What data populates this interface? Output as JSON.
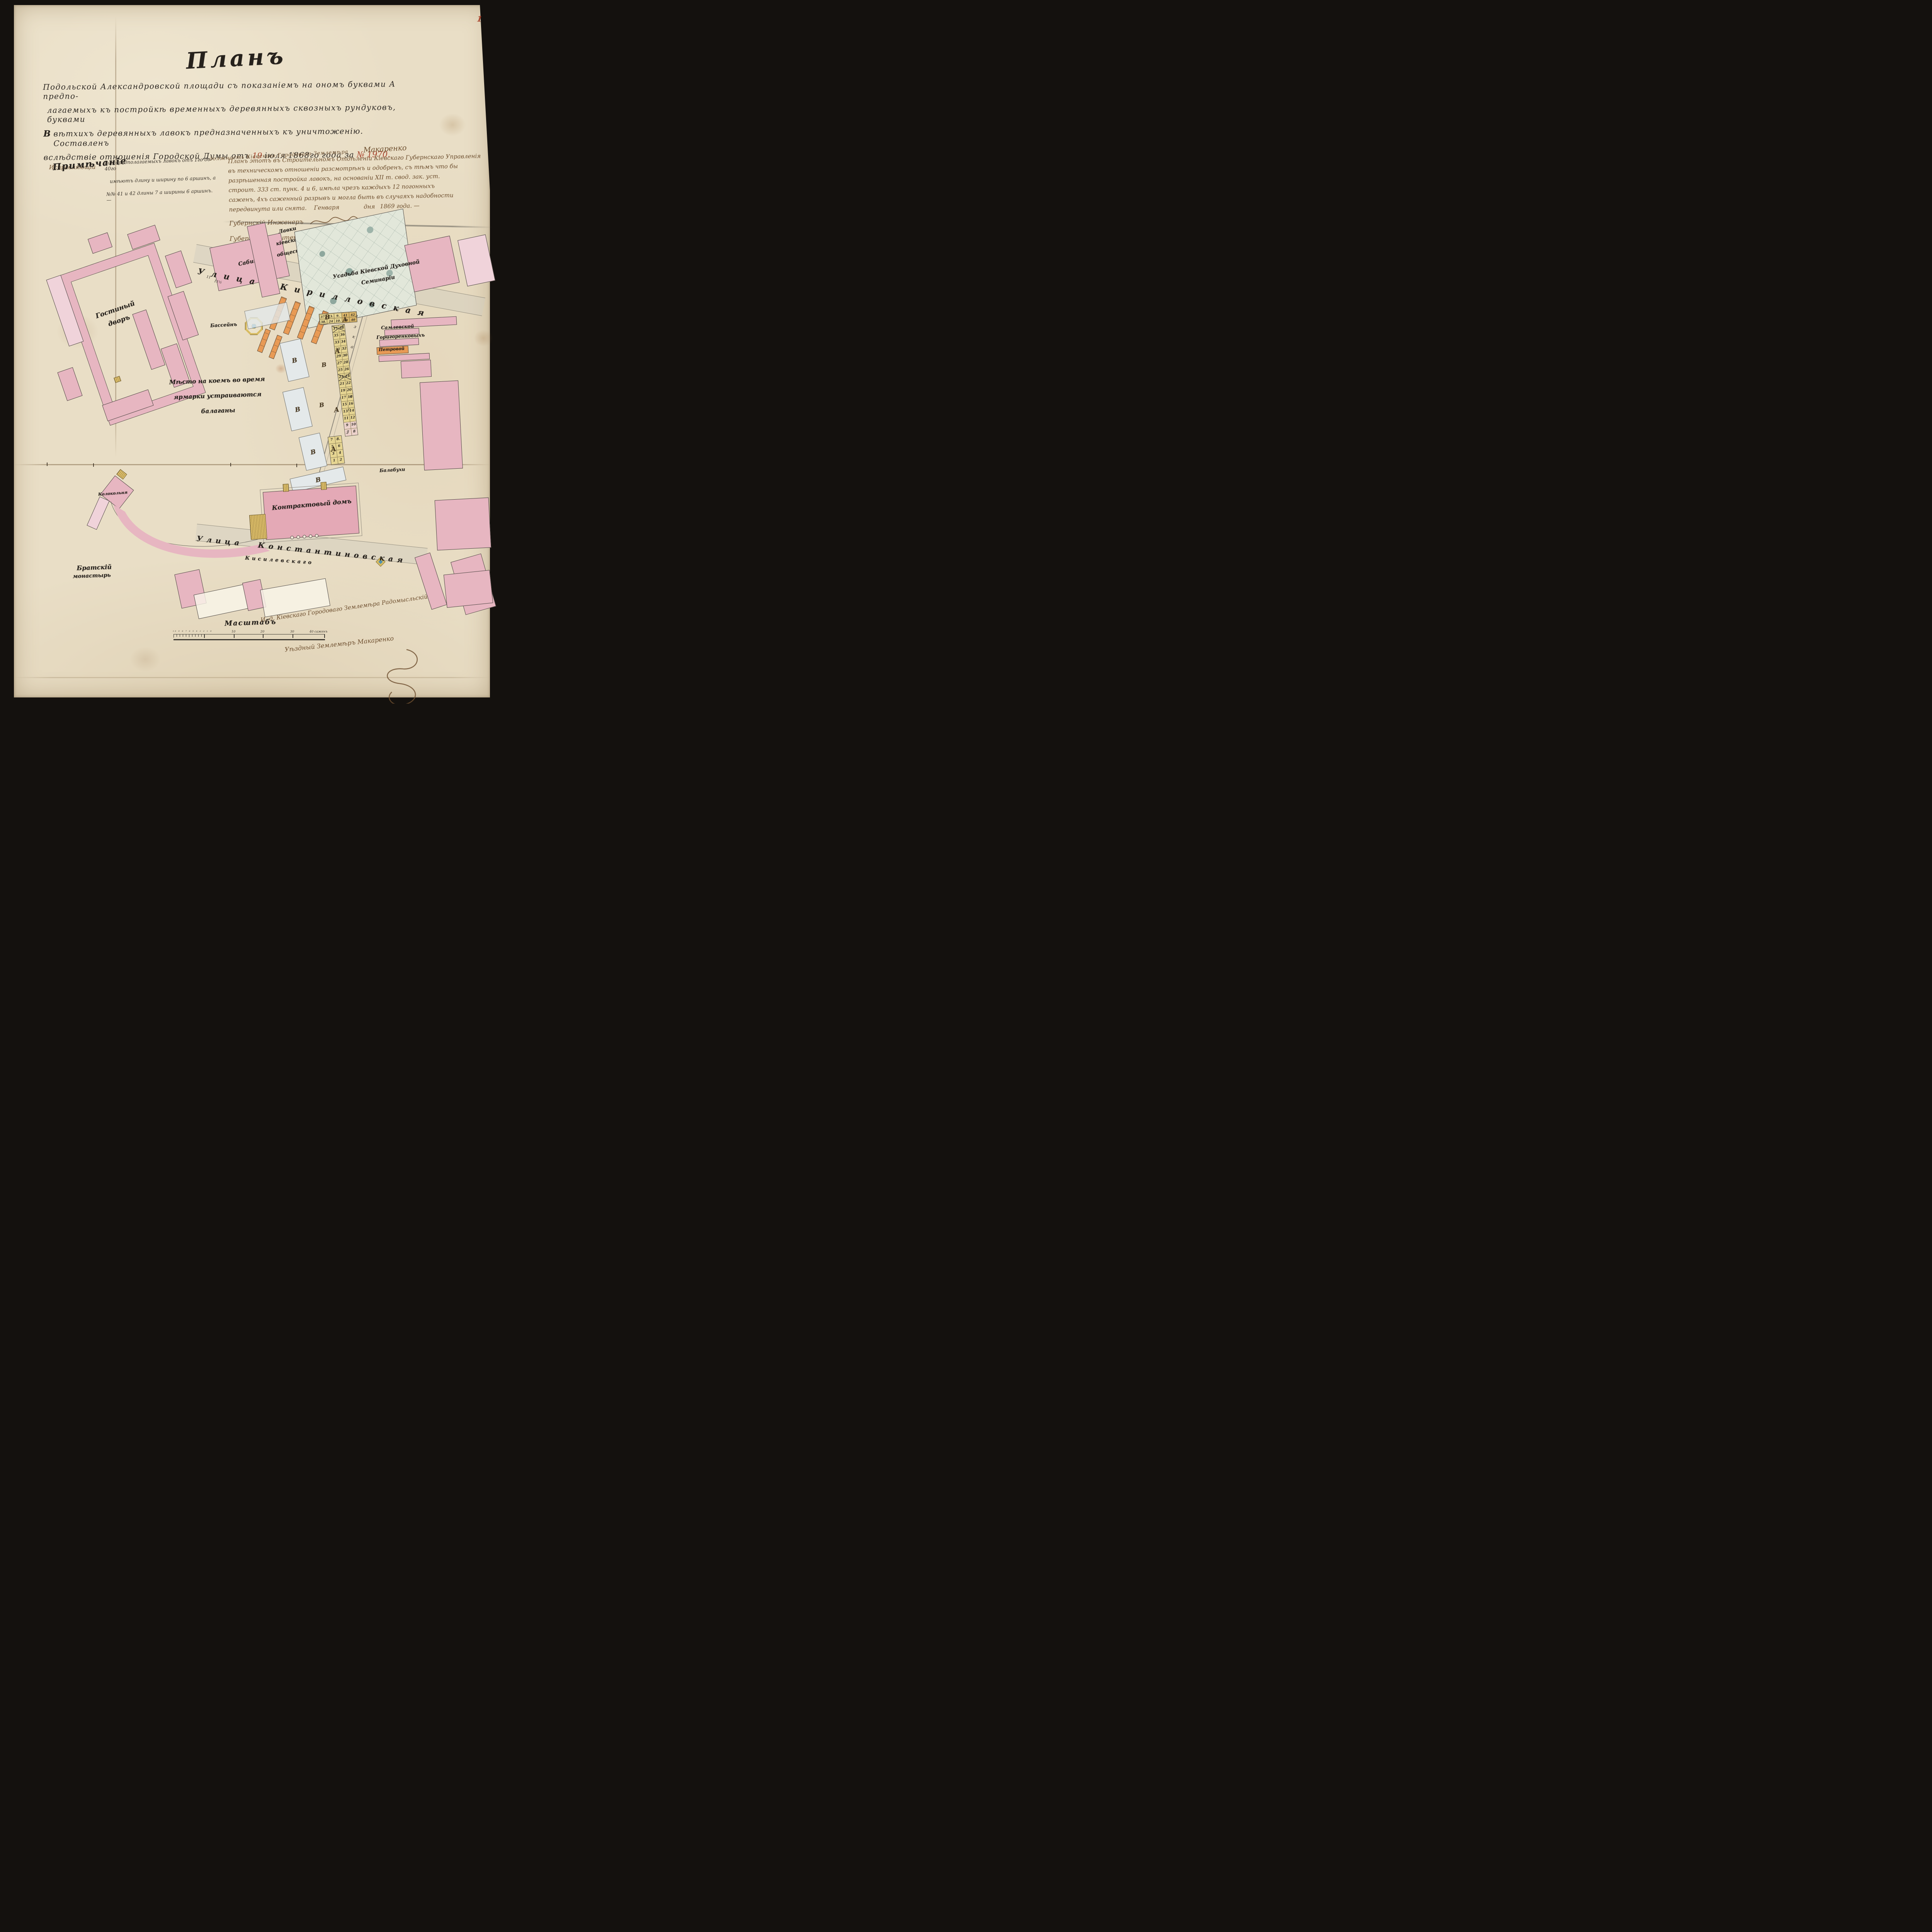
{
  "page": {
    "number": "1"
  },
  "title": "Планъ",
  "description": {
    "l1": "Подольской Александровской площади съ показаніемъ на ономъ буквами А предпо-",
    "l2": "лагаемыхъ къ постройкѣ временныхъ деревянныхъ сквозныхъ рундуковъ, буквами",
    "l3_letter": "В",
    "l3": " вѣтхихъ деревянныхъ лавокъ предназначенныхъ къ уничтоженію.",
    "l3_end": "Составленъ",
    "l4a": "вслѣдствіе отношенія Городской Думы отъ",
    "l4_day": "19",
    "l4b": "іюля",
    "l4_year": "1868го",
    "l4c": "года за",
    "l4_num": "№ 1970.",
    "l4_append": "Исправляющій"
  },
  "clerk": {
    "text": "должность Кіевскаго Городоваго Землемѣра",
    "signature": "Макаренко"
  },
  "note": {
    "heading": "Примѣчаніе",
    "l1": "№№ предполагаемыхъ лавокъ отъ 1го до 40го",
    "l2": "имѣютъ длину и ширину по 6 аршинъ, а",
    "l3": "№№ 41 и 42 длины 7 а ширины 6 аршинъ. —"
  },
  "approval": {
    "l1": "Планъ этотъ въ Строительномъ Отдѣленіи Кіевскаго Губернскаго Управленія",
    "l2": "въ техническомъ отношеніи разсмотрѣнъ и одобренъ, съ тѣмъ что бы",
    "l3": "разрѣшенная постройка лавокъ, на основаніи XII т. свод. зак. уст.",
    "l4": "строит. 333 ст. пунк. 4 и 6, имѣла чрезъ каждыхъ 12 погонныхъ",
    "l5": "саженъ, 4хъ саженный разрывъ и могла быть въ случаяхъ надобности",
    "l6": "передвинута или снята.",
    "date_month": "Генваря",
    "date_day": "дня",
    "date_year": "1869 года. —",
    "engineer_title": "Губернскій Инженеръ",
    "architect_title": "Губернскій Архитекторъ"
  },
  "map": {
    "streets": {
      "kirillovskaya_word1": "Улица",
      "kirillovskaya_word2": "Кирилловская",
      "konstantinovskaya_word1": "Улица",
      "konstantinovskaya_word2": "Константиновская"
    },
    "labels": {
      "sabina": "Сабина",
      "lavki_l1": "Лавки",
      "lavki_l2": "кіевскаго",
      "lavki_l3": "общества",
      "seminary_l1": "Усадьба Кіевской Духовной",
      "seminary_l2": "Семинаріи",
      "gostiny_l1": "Гостиный",
      "gostiny_l2": "дворъ",
      "fair_l1": "Мѣсто на коемъ во время",
      "fair_l2": "ярмарки устраиваются",
      "fair_l3": "балаганы",
      "basin": "Бассейнъ",
      "samlevskoy": "Самлевской",
      "gorigorenkovyh": "Горигоренковыхъ",
      "petrovoy": "Петровой",
      "balabuhi": "Балабухи",
      "kontraktovy": "Контрактовый домъ",
      "kiselevskogo": "Кисилевскаго",
      "bratsky_l1": "Братскій",
      "bratsky_l2": "монастырь",
      "kolokolnya": "Колокольня"
    },
    "letters": {
      "A": "А",
      "B": "В"
    },
    "width_marks": [
      "11",
      "11½"
    ],
    "survey_marks": [
      "з",
      "з",
      "к",
      "а",
      "п",
      "с",
      "з"
    ],
    "stalls": {
      "top_r1": [
        "37.",
        "23.",
        "9.",
        "41",
        "42"
      ],
      "top_r2": [
        "38.",
        "24",
        "10.",
        "39",
        "40"
      ],
      "vertical": [
        {
          "l": "37",
          "r": "38"
        },
        {
          "l": "35",
          "r": "36"
        },
        {
          "l": "33",
          "r": "34"
        },
        {
          "l": "31",
          "r": "32"
        },
        {
          "l": "29",
          "r": "30"
        },
        {
          "l": "27",
          "r": "28"
        },
        {
          "l": "25",
          "r": "26"
        },
        {
          "l": "23",
          "r": "24"
        },
        {
          "l": "21",
          "r": "22"
        },
        {
          "l": "19",
          "r": "20"
        },
        {
          "l": "17",
          "r": "18"
        },
        {
          "l": "15",
          "r": "16"
        },
        {
          "l": "13",
          "r": "14"
        },
        {
          "l": "11",
          "r": "12"
        },
        {
          "l": "9",
          "r": "10"
        },
        {
          "l": "7",
          "r": "8"
        }
      ],
      "bottom": [
        {
          "l": "7",
          "r": "8."
        },
        {
          "l": "5",
          "r": "6"
        },
        {
          "l": "3",
          "r": "4"
        },
        {
          "l": "1",
          "r": "2"
        }
      ]
    }
  },
  "scale": {
    "label": "Масштабъ",
    "minor_digits": "10 9 8 7 6 5 4 3 2 1 0",
    "t10": "10",
    "t20": "20",
    "t30": "30",
    "t40": "40 саженъ"
  },
  "signatures": {
    "line1": "И. д. Кіевскаго Городоваго Землемѣра Радомысльскій",
    "line2": "Уѣздный Землемѣръ Макаренко"
  },
  "colors": {
    "paper": "#e8ddc4",
    "ink": "#2f2a25",
    "brown_ink": "#6e4f2f",
    "red_ink": "#a8432c",
    "pink": "#e7b6c1",
    "orange": "#e89a55",
    "stall_yellow": "#e6d592",
    "seminary_green": "#dfe5d8",
    "gold": "#d8bc62",
    "well_blue": "#4f8fae"
  }
}
